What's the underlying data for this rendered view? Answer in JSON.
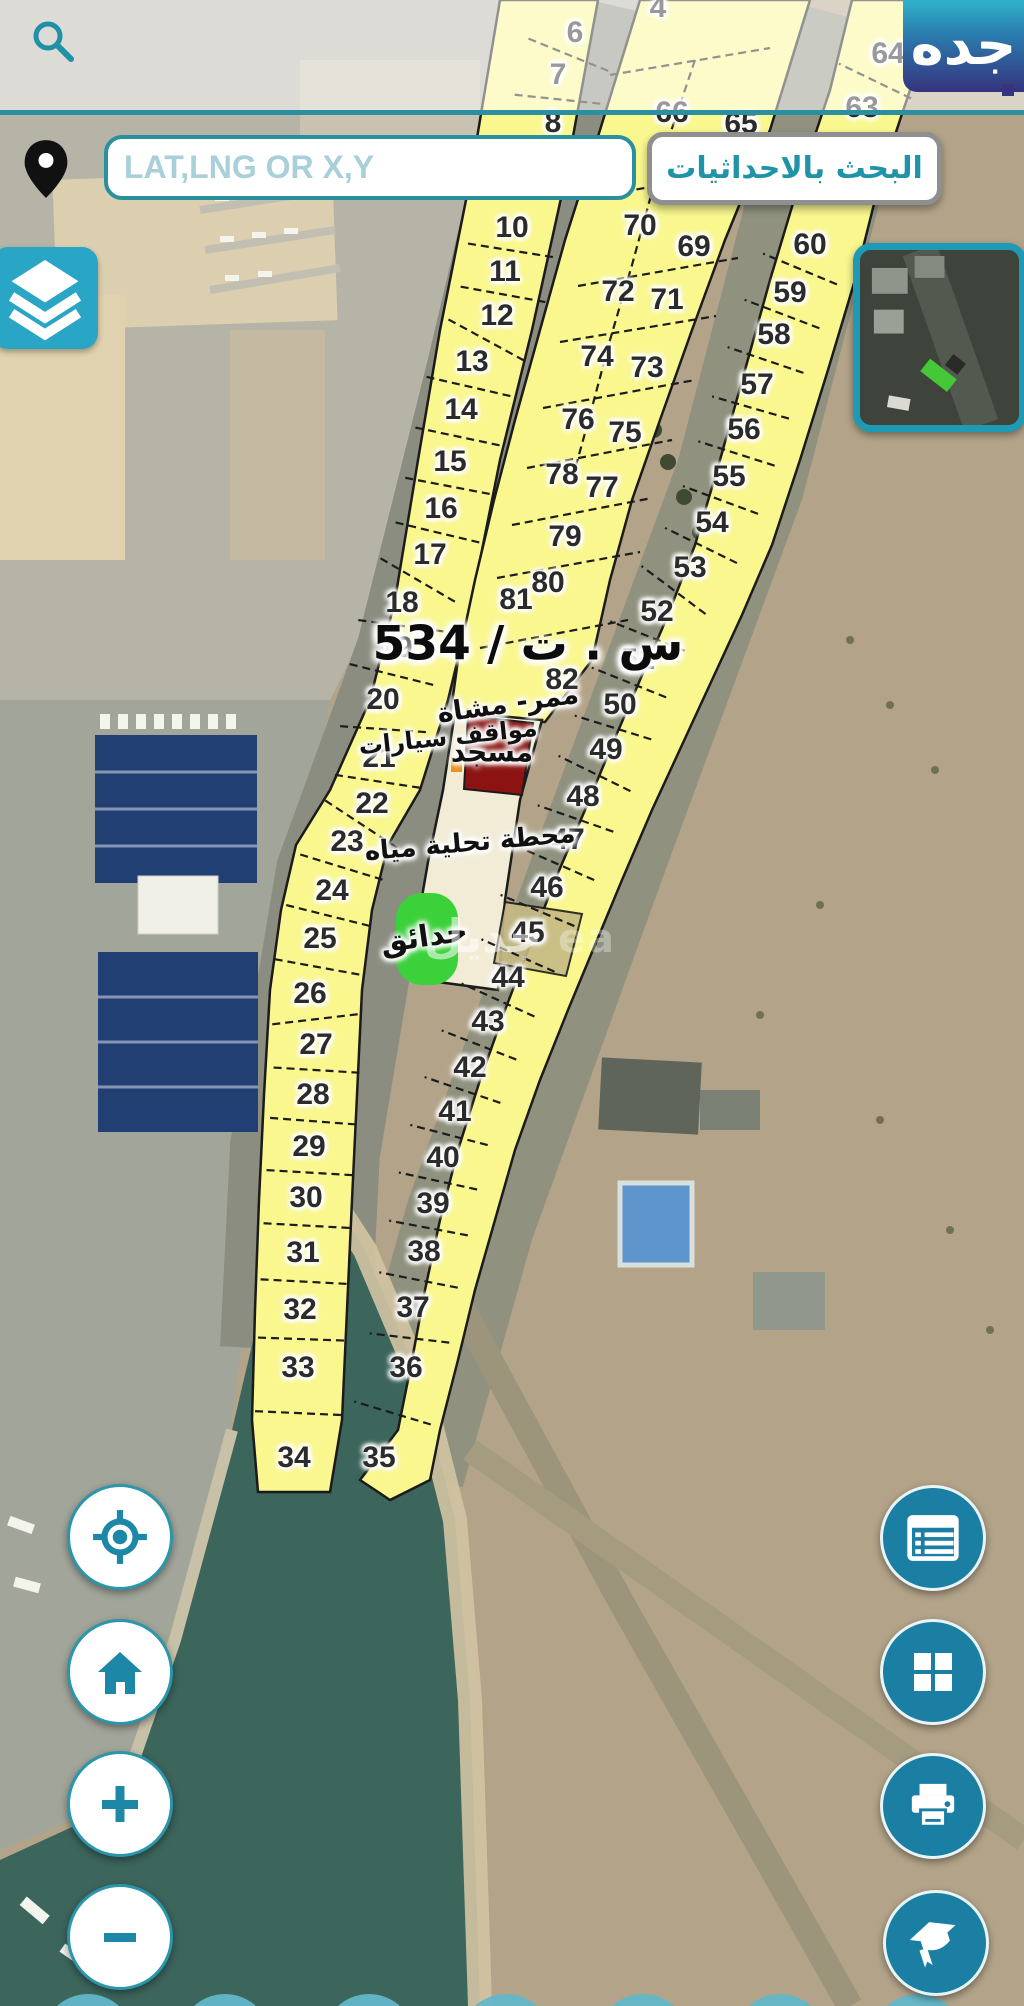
{
  "header": {
    "logo": "جده"
  },
  "search": {
    "placeholder": "LAT,LNG OR X,Y",
    "button": "البحث بالاحداثيات"
  },
  "map": {
    "big_label": {
      "t": "س . ت / 534",
      "x": 528,
      "y": 644
    },
    "watermark": {
      "ar": "جديل",
      "la": "ea",
      "x": 520,
      "y": 936
    },
    "labels": [
      {
        "t": "ممر- مشاة",
        "x": 508,
        "y": 704,
        "fs": 27,
        "r": -8
      },
      {
        "t": "مواقف سيارات",
        "x": 448,
        "y": 737,
        "fs": 24,
        "r": -6
      },
      {
        "t": "مسجد",
        "x": 492,
        "y": 752,
        "fs": 28,
        "r": 0
      },
      {
        "t": "محطة تحلية مياه",
        "x": 470,
        "y": 843,
        "fs": 26,
        "r": -5
      },
      {
        "t": "حدائق",
        "x": 424,
        "y": 937,
        "fs": 30,
        "r": -8
      }
    ],
    "parcels": [
      {
        "n": "6",
        "x": 575,
        "y": 33,
        "s": "s1"
      },
      {
        "n": "7",
        "x": 558,
        "y": 75,
        "s": "s1"
      },
      {
        "n": "8",
        "x": 553,
        "y": 123,
        "s": "s1"
      },
      {
        "n": "10",
        "x": 512,
        "y": 228,
        "s": "s1"
      },
      {
        "n": "11",
        "x": 505,
        "y": 272,
        "s": "s1"
      },
      {
        "n": "12",
        "x": 497,
        "y": 316,
        "s": "s1"
      },
      {
        "n": "13",
        "x": 472,
        "y": 362,
        "s": "s1"
      },
      {
        "n": "14",
        "x": 461,
        "y": 410,
        "s": "s1"
      },
      {
        "n": "15",
        "x": 450,
        "y": 462,
        "s": "s1"
      },
      {
        "n": "16",
        "x": 441,
        "y": 509,
        "s": "s1"
      },
      {
        "n": "17",
        "x": 430,
        "y": 555,
        "s": "s1"
      },
      {
        "n": "18",
        "x": 402,
        "y": 603,
        "s": "s1"
      },
      {
        "n": "19",
        "x": 396,
        "y": 648,
        "s": "s1"
      },
      {
        "n": "20",
        "x": 383,
        "y": 700,
        "s": "s1"
      },
      {
        "n": "21",
        "x": 379,
        "y": 758,
        "s": "s1"
      },
      {
        "n": "22",
        "x": 372,
        "y": 804,
        "s": "s1"
      },
      {
        "n": "23",
        "x": 347,
        "y": 842,
        "s": "s1"
      },
      {
        "n": "24",
        "x": 332,
        "y": 891,
        "s": "s1"
      },
      {
        "n": "25",
        "x": 320,
        "y": 939,
        "s": "s1"
      },
      {
        "n": "26",
        "x": 310,
        "y": 994,
        "s": "s1"
      },
      {
        "n": "27",
        "x": 316,
        "y": 1045,
        "s": "s1"
      },
      {
        "n": "28",
        "x": 313,
        "y": 1095,
        "s": "s1"
      },
      {
        "n": "29",
        "x": 309,
        "y": 1147,
        "s": "s1"
      },
      {
        "n": "30",
        "x": 306,
        "y": 1198,
        "s": "s1"
      },
      {
        "n": "31",
        "x": 303,
        "y": 1253,
        "s": "s1"
      },
      {
        "n": "32",
        "x": 300,
        "y": 1310,
        "s": "s1"
      },
      {
        "n": "33",
        "x": 298,
        "y": 1368,
        "s": "s1"
      },
      {
        "n": "34",
        "x": 294,
        "y": 1458,
        "s": "s1"
      },
      {
        "n": "4",
        "x": 658,
        "y": 8,
        "s": "s2"
      },
      {
        "n": "66",
        "x": 672,
        "y": 113,
        "s": "s2"
      },
      {
        "n": "65",
        "x": 741,
        "y": 124,
        "s": "s2"
      },
      {
        "n": "70",
        "x": 640,
        "y": 226,
        "s": "s2"
      },
      {
        "n": "69",
        "x": 694,
        "y": 247,
        "s": "s2"
      },
      {
        "n": "72",
        "x": 618,
        "y": 292,
        "s": "s2"
      },
      {
        "n": "71",
        "x": 667,
        "y": 300,
        "s": "s2"
      },
      {
        "n": "74",
        "x": 597,
        "y": 357,
        "s": "s2"
      },
      {
        "n": "73",
        "x": 647,
        "y": 368,
        "s": "s2"
      },
      {
        "n": "76",
        "x": 578,
        "y": 420,
        "s": "s2"
      },
      {
        "n": "75",
        "x": 625,
        "y": 433,
        "s": "s2"
      },
      {
        "n": "78",
        "x": 562,
        "y": 475,
        "s": "s2"
      },
      {
        "n": "77",
        "x": 602,
        "y": 488,
        "s": "s2"
      },
      {
        "n": "79",
        "x": 565,
        "y": 537,
        "s": "s2"
      },
      {
        "n": "80",
        "x": 548,
        "y": 583,
        "s": "s2"
      },
      {
        "n": "81",
        "x": 516,
        "y": 600,
        "s": "s2"
      },
      {
        "n": "82",
        "x": 562,
        "y": 680,
        "s": "s2"
      },
      {
        "n": "64",
        "x": 888,
        "y": 54,
        "s": "s3"
      },
      {
        "n": "63",
        "x": 862,
        "y": 108,
        "s": "s3"
      },
      {
        "n": "60",
        "x": 810,
        "y": 245,
        "s": "s3"
      },
      {
        "n": "59",
        "x": 790,
        "y": 293,
        "s": "s3"
      },
      {
        "n": "58",
        "x": 774,
        "y": 335,
        "s": "s3"
      },
      {
        "n": "57",
        "x": 757,
        "y": 385,
        "s": "s3"
      },
      {
        "n": "56",
        "x": 744,
        "y": 430,
        "s": "s3"
      },
      {
        "n": "55",
        "x": 729,
        "y": 477,
        "s": "s3"
      },
      {
        "n": "54",
        "x": 712,
        "y": 523,
        "s": "s3"
      },
      {
        "n": "53",
        "x": 690,
        "y": 568,
        "s": "s3"
      },
      {
        "n": "52",
        "x": 657,
        "y": 612,
        "s": "s3"
      },
      {
        "n": "51",
        "x": 638,
        "y": 660,
        "s": "s3"
      },
      {
        "n": "50",
        "x": 620,
        "y": 705,
        "s": "s3"
      },
      {
        "n": "49",
        "x": 606,
        "y": 750,
        "s": "s3"
      },
      {
        "n": "48",
        "x": 583,
        "y": 797,
        "s": "s3"
      },
      {
        "n": "47",
        "x": 568,
        "y": 840,
        "s": "s3"
      },
      {
        "n": "46",
        "x": 547,
        "y": 888,
        "s": "s3"
      },
      {
        "n": "45",
        "x": 528,
        "y": 933,
        "s": "s3"
      },
      {
        "n": "44",
        "x": 508,
        "y": 978,
        "s": "s3"
      },
      {
        "n": "43",
        "x": 488,
        "y": 1022,
        "s": "s3"
      },
      {
        "n": "42",
        "x": 470,
        "y": 1068,
        "s": "s3"
      },
      {
        "n": "41",
        "x": 455,
        "y": 1112,
        "s": "s3"
      },
      {
        "n": "40",
        "x": 443,
        "y": 1158,
        "s": "s3"
      },
      {
        "n": "39",
        "x": 433,
        "y": 1204,
        "s": "s3"
      },
      {
        "n": "38",
        "x": 424,
        "y": 1252,
        "s": "s3"
      },
      {
        "n": "37",
        "x": 413,
        "y": 1308,
        "s": "s3"
      },
      {
        "n": "36",
        "x": 406,
        "y": 1368,
        "s": "s3"
      },
      {
        "n": "35",
        "x": 379,
        "y": 1458,
        "s": "s3"
      }
    ]
  },
  "controls": {
    "left": [
      {
        "name": "locate"
      },
      {
        "name": "home"
      },
      {
        "name": "zoom-in"
      },
      {
        "name": "zoom-out"
      }
    ],
    "right": [
      {
        "name": "parcel-table"
      },
      {
        "name": "apps-grid"
      },
      {
        "name": "print"
      },
      {
        "name": "education"
      }
    ]
  },
  "colors": {
    "teal": "#2a8f9f",
    "button_fill": "#1b7fa3",
    "parcel_yellow": "#f9f78e",
    "mosque_red": "#8c1311",
    "garden_green": "#3bd13b"
  }
}
